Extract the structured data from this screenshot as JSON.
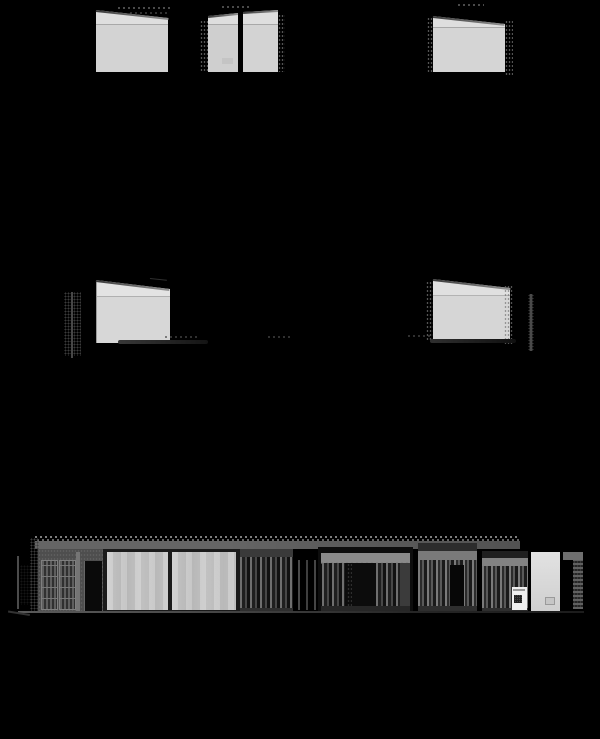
{
  "sheet": {
    "description_visible_text": [],
    "legible_text": []
  },
  "palette": {
    "bg": "#000000",
    "wall": "#d3d3d3",
    "wall_band": "#dedede",
    "wall_line": "#a8a8a8",
    "roof_dark": "#3a3a3a",
    "roof_light": "#909090",
    "glass": "#c9c9c9",
    "fascia": "#656565",
    "header": "#8a8a8a",
    "recess": "#121212",
    "frame": "#1b1b1b",
    "facade": "#4e4e4e",
    "slat_light": "#707070",
    "slat_dark": "#1f1f1f",
    "opening": "#0a0a0a",
    "door": "#d8d8d8",
    "appliance": "#efefef",
    "ground": "#4a4a4a",
    "speckle": "#8c8c8c",
    "tree": "#2e2e2e",
    "annotation": "#4a4a4a"
  }
}
